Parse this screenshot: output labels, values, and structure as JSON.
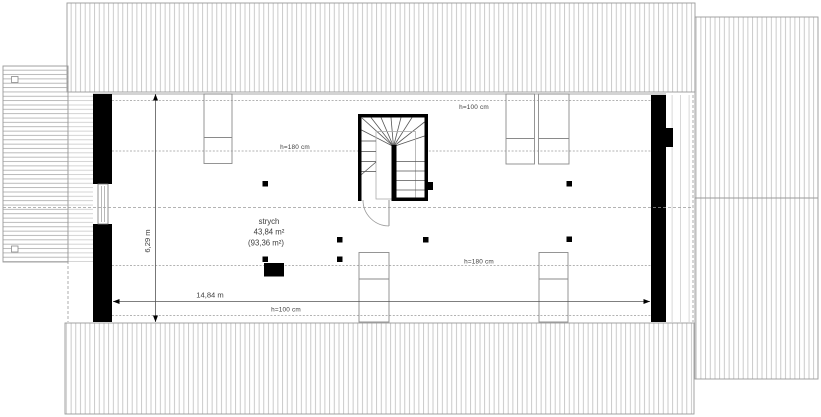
{
  "plan": {
    "type": "attic floor plan",
    "room": {
      "name": "strych",
      "area": "43,84 m²",
      "area_total": "(93,36 m²)"
    },
    "dimensions": {
      "width": "14,84 m",
      "depth": "6,29 m"
    },
    "heights": {
      "h100": "h=100 cm",
      "h180": "h=180 cm"
    },
    "colors": {
      "wall": "#000000",
      "outline": "#8a8a8a",
      "roof_hatch": "#bcbcbc",
      "dashed_line": "#9a9a9a",
      "text": "#3d3d3d",
      "background": "#ffffff"
    }
  }
}
